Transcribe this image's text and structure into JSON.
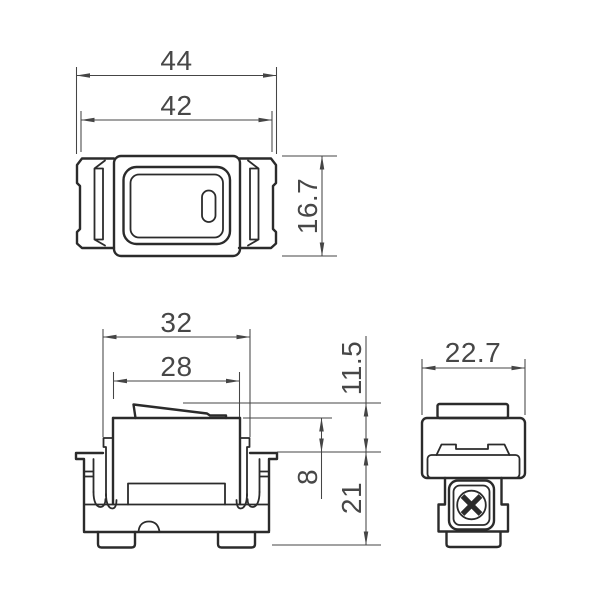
{
  "drawing_title": "rocker-switch-three-view-dimension-drawing",
  "views": {
    "front": {
      "width_overall": "44",
      "width_inner": "42",
      "height": "16.7"
    },
    "side": {
      "width_hooks": "32",
      "width_body": "28",
      "rocker_height_above_flange": "11.5",
      "body_height_above_flange": "8",
      "depth_below_flange": "21"
    },
    "profile": {
      "width": "22.7"
    }
  },
  "colors": {
    "background": "#ffffff",
    "outline": "#2b2b2b",
    "dimension": "#454545"
  }
}
